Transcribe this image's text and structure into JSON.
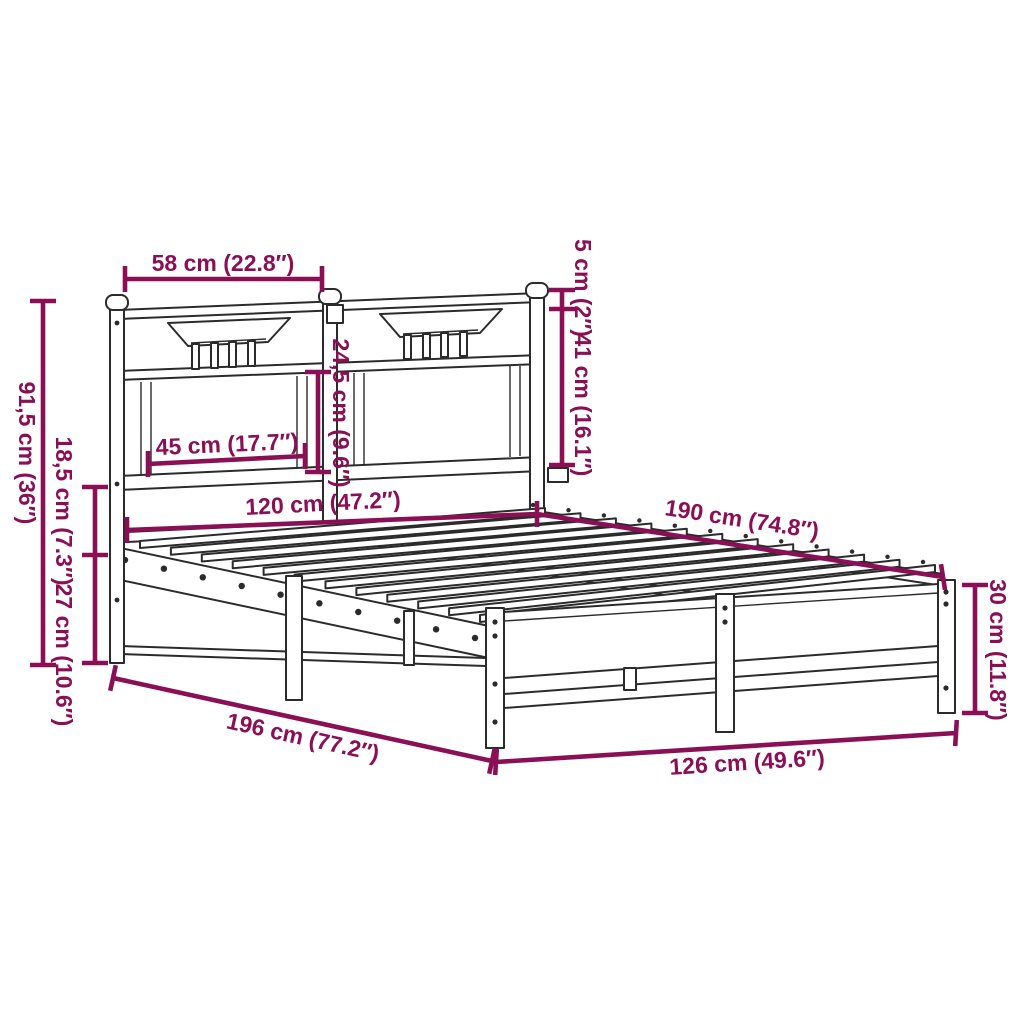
{
  "diagram": {
    "type": "product-dimension-diagram",
    "subject": "metal bed frame with headboard and footboard",
    "colors": {
      "dimension_annotation": "#8A0F55",
      "line_art": "#2B2B2B",
      "background": "#FFFFFF"
    },
    "labels": {
      "headboard_section_width": "58 cm (22.8″)",
      "post_cap_height": "5 cm (2″)",
      "headboard_upper_height": "41 cm (16.1″)",
      "headboard_total_height": "91,5 cm (36″)",
      "rail_height": "18,5 cm (7.3″)",
      "under_bed_clearance": "27 cm (10.6″)",
      "headboard_panel_width": "45 cm (17.7″)",
      "headboard_panel_height": "24,5 cm (9.6″)",
      "mattress_width": "120 cm (47.2″)",
      "mattress_length": "190 cm (74.8″)",
      "footboard_height": "30 cm (11.8″)",
      "overall_length": "196 cm (77.2″)",
      "overall_width": "126 cm (49.6″)"
    }
  }
}
